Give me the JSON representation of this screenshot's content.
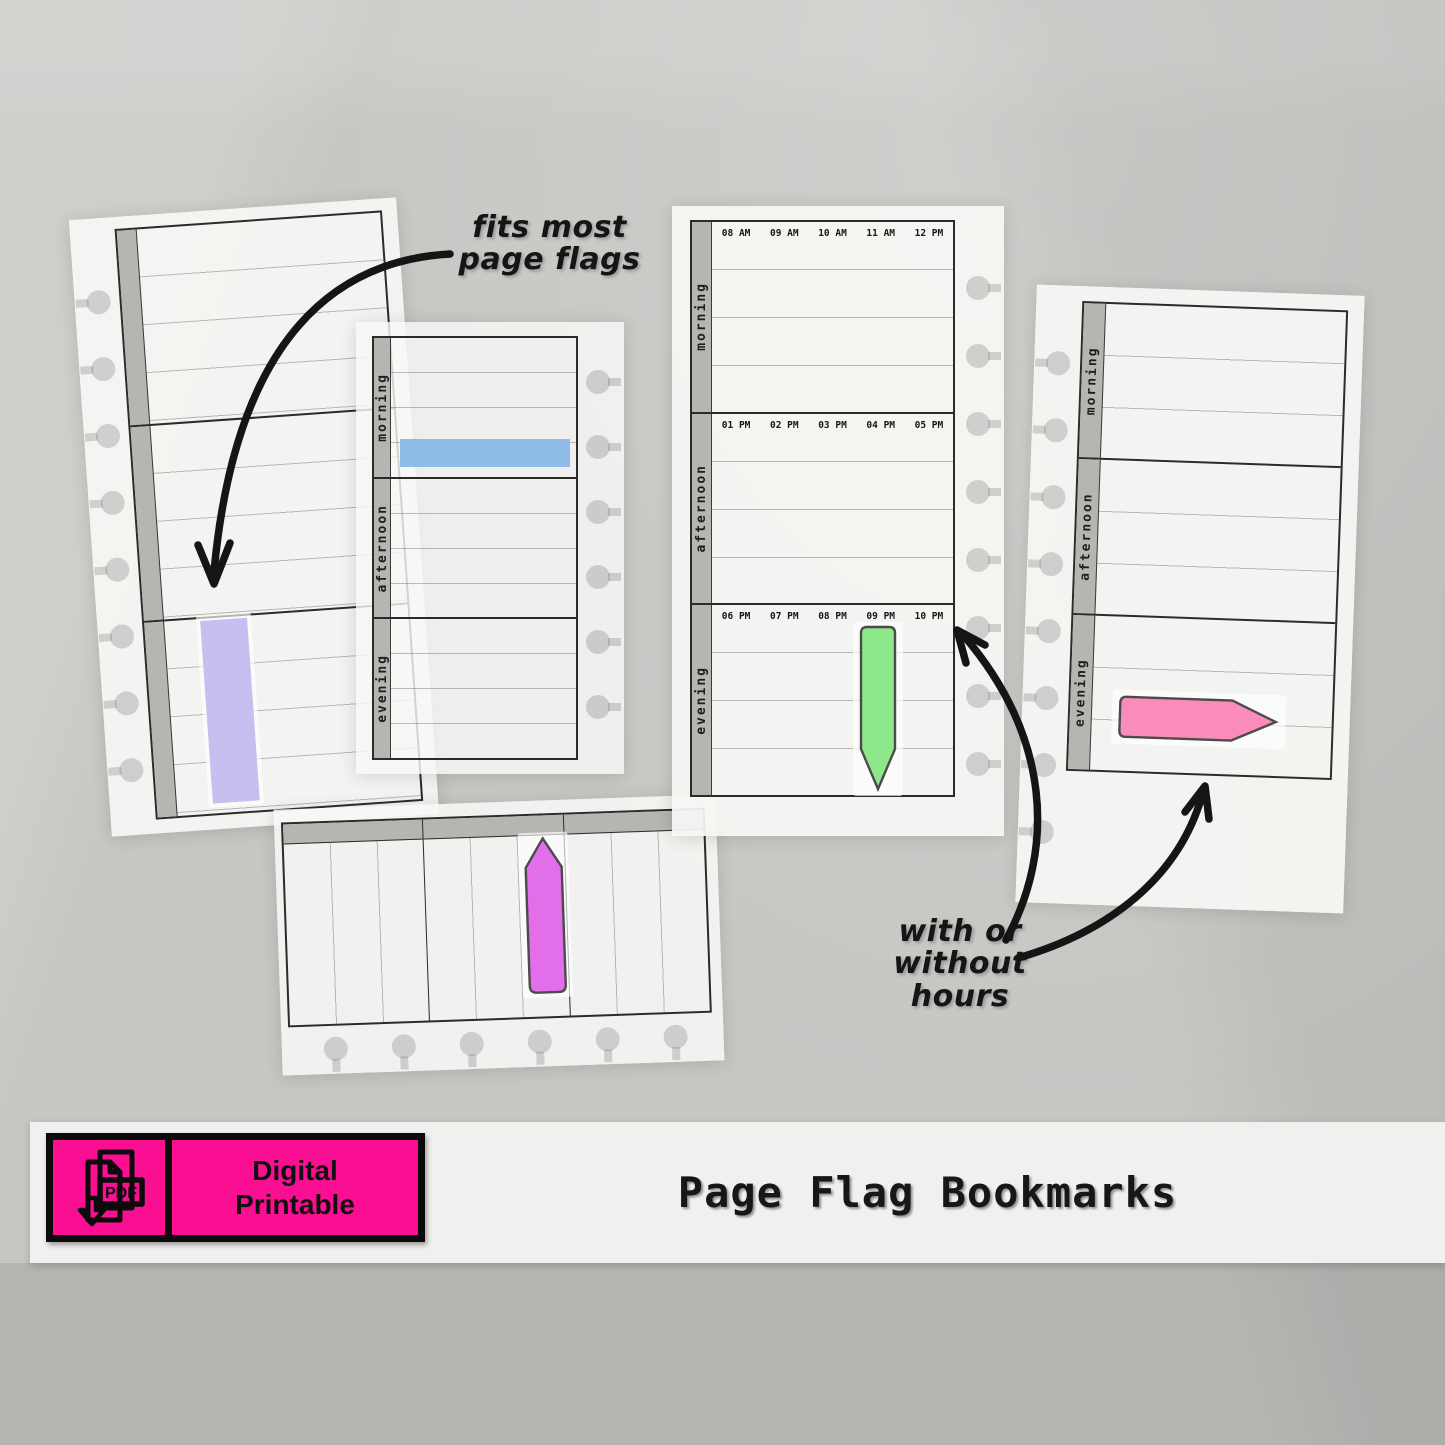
{
  "labels": {
    "morning": "morning",
    "afternoon": "afternoon",
    "evening": "evening"
  },
  "hours": {
    "morning": [
      "08 AM",
      "09 AM",
      "10 AM",
      "11 AM",
      "12 PM"
    ],
    "afternoon": [
      "01 PM",
      "02 PM",
      "03 PM",
      "04 PM",
      "05 PM"
    ],
    "evening": [
      "06 PM",
      "07 PM",
      "08 PM",
      "09 PM",
      "10 PM"
    ]
  },
  "annotations": {
    "fits_line1": "fits most",
    "fits_line2": "page flags",
    "hours_line1": "with or",
    "hours_line2": "without hours"
  },
  "flags": {
    "blue": "#8fbce9",
    "lavender": "#c5c0f0",
    "green": "#8de88a",
    "violet": "#e26fe9",
    "pink": "#fa8cba"
  },
  "banner": {
    "badge_bg": "#fb0f92",
    "pdf_label": "PDF",
    "badge_line1": "Digital",
    "badge_line2": "Printable",
    "title": "Page Flag Bookmarks"
  }
}
